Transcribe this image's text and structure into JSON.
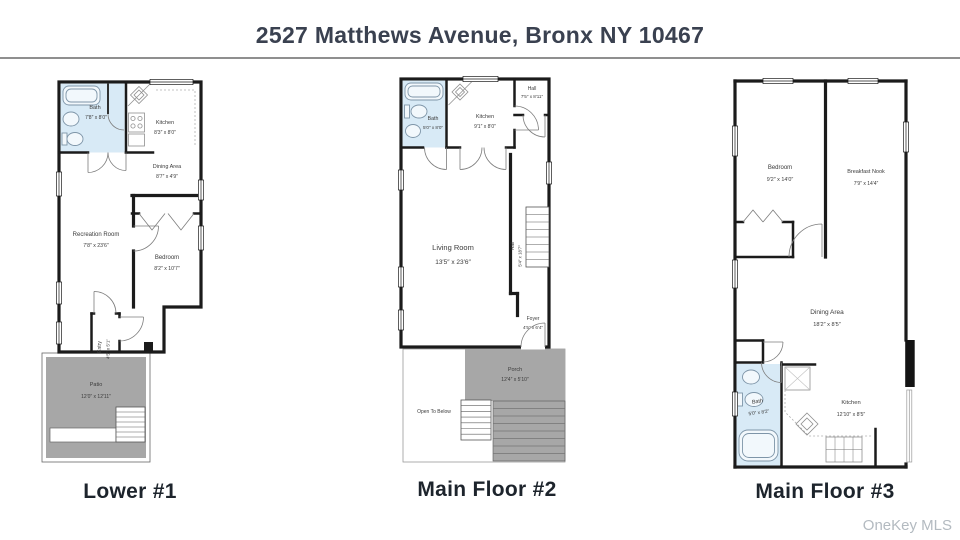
{
  "header": {
    "title": "2527 Matthews Avenue, Bronx NY 10467"
  },
  "watermark": "OneKey MLS",
  "colors": {
    "wall": "#1b1b1b",
    "bath_fill": "#d8eaf6",
    "deck_fill": "#a7a7a7",
    "title_text": "#3a4150",
    "label_text": "#1d242c",
    "watermark_text": "#b3bac0"
  },
  "plans": [
    {
      "label": "Lower #1",
      "rooms": [
        {
          "name": "Bath",
          "dims": "7′8″ x 8′0″"
        },
        {
          "name": "Kitchen",
          "dims": "8′3″ x 8′0″"
        },
        {
          "name": "Dining Area",
          "dims": "8′7″ x 4′9″"
        },
        {
          "name": "Recreation Room",
          "dims": "7′8″ x 23′6″"
        },
        {
          "name": "Bedroom",
          "dims": "8′2″ x 10′7″"
        },
        {
          "name": "Entry",
          "dims": "4′5″ x 5′1″"
        },
        {
          "name": "Patio",
          "dims": "12′0″ x 12′11″"
        }
      ]
    },
    {
      "label": "Main Floor #2",
      "rooms": [
        {
          "name": "Bath",
          "dims": "5′0″ x 8′0″"
        },
        {
          "name": "Kitchen",
          "dims": "9′1″ x 8′0″"
        },
        {
          "name": "Hall",
          "dims": "7′5″ x 8′11″"
        },
        {
          "name": "Living Room",
          "dims": "13′5″ x 23′6″"
        },
        {
          "name": "Hall",
          "dims": "5′4″ x 18′7″"
        },
        {
          "name": "Foyer",
          "dims": "4′5″ x 6′4″"
        },
        {
          "name": "Porch",
          "dims": "12′4″ x 5′10″"
        },
        {
          "name": "Open To Below",
          "dims": ""
        }
      ]
    },
    {
      "label": "Main Floor #3",
      "rooms": [
        {
          "name": "Bedroom",
          "dims": "9′2″ x 14′0″"
        },
        {
          "name": "Breakfast Nook",
          "dims": "7′9″ x 14′4″"
        },
        {
          "name": "Dining Area",
          "dims": "18′2″ x 8′5″"
        },
        {
          "name": "Bath",
          "dims": "5′0″ x 8′2″"
        },
        {
          "name": "Kitchen",
          "dims": "12′10″ x 8′5″"
        }
      ]
    }
  ]
}
